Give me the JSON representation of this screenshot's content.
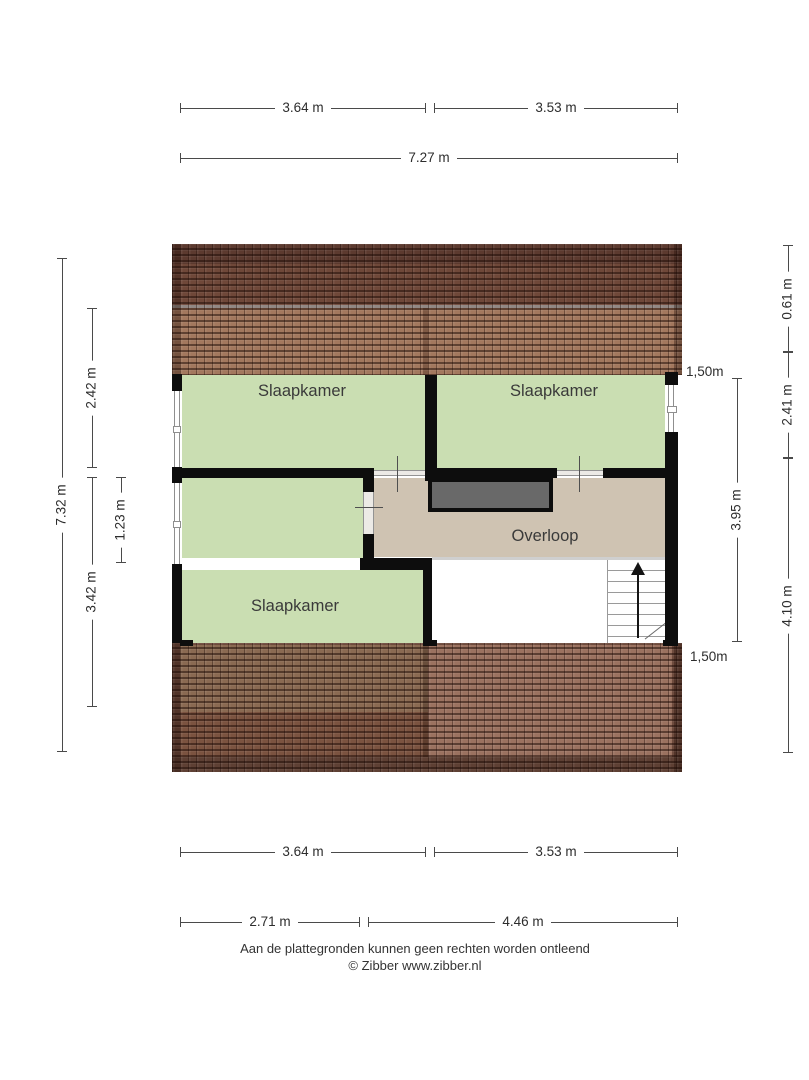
{
  "plan": {
    "rooms": {
      "bedroom_top_left": {
        "label": "Slaapkamer"
      },
      "bedroom_top_right": {
        "label": "Slaapkamer"
      },
      "bedroom_bottom_left": {
        "label": "Slaapkamer"
      },
      "landing": {
        "label": "Overloop"
      }
    },
    "annotations": {
      "headroom_top": {
        "label": "1,50m"
      },
      "headroom_bottom": {
        "label": "1,50m"
      }
    }
  },
  "dimensions": {
    "top_row": {
      "left": {
        "label": "3.64 m"
      },
      "right": {
        "label": "3.53 m"
      },
      "total": {
        "label": "7.27 m"
      }
    },
    "bottom_row": {
      "left": {
        "label": "3.64 m"
      },
      "right": {
        "label": "3.53 m"
      },
      "left2": {
        "label": "2.71 m"
      },
      "right2": {
        "label": "4.46 m"
      }
    },
    "left_col": {
      "total": {
        "label": "7.32 m"
      },
      "top": {
        "label": "2.42 m"
      },
      "inner": {
        "label": "1.23 m"
      },
      "bottom": {
        "label": "3.42 m"
      }
    },
    "right_col": {
      "ridge": {
        "label": "0.61 m"
      },
      "top": {
        "label": "2.41 m"
      },
      "inner": {
        "label": "3.95 m"
      },
      "bottom": {
        "label": "4.10 m"
      }
    }
  },
  "footer": {
    "disclaimer": "Aan de plattegronden kunnen geen rechten worden ontleend",
    "credit": "© Zibber www.zibber.nl"
  },
  "colors": {
    "room_green": "#cadeb2",
    "landing_beige": "#cfc3b2",
    "roof_ridge_dark": "#5c3a2f",
    "roof_upper_dark": "#6f4839",
    "roof_upper_light": "#a3785e",
    "roof_lower_base": "#6e4b3d",
    "closet_grey": "#696969",
    "wall_black": "#0d0d0d",
    "dimension_line": "#4a4a4a"
  }
}
